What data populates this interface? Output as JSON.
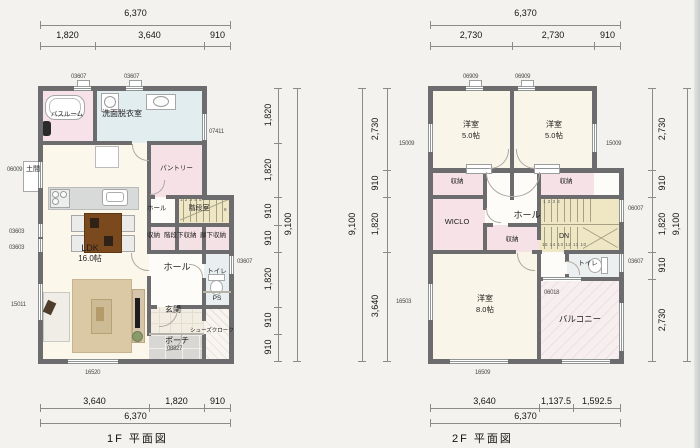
{
  "f1": {
    "caption": "1F 平面図",
    "rooms": {
      "bath": "バスルーム",
      "wash": "洗面脱衣室",
      "doma": "土間",
      "pantry": "パントリー",
      "hall_upper": "ホール",
      "stair": "階段室",
      "sto1": "収納",
      "sto2": "階段下収納",
      "sto3": "廊下収納",
      "ldk_name": "LDK",
      "ldk_size": "16.0帖",
      "hall": "ホール",
      "toilet": "トイレ",
      "ps": "PS",
      "genkan": "玄関",
      "shoes": "シューズクローク",
      "porch": "ポーチ"
    },
    "codes": {
      "top1": "03607",
      "top2": "03607",
      "right_upper": "07411",
      "right_lower": "03607",
      "left_doma": "06009",
      "left1": "03603",
      "left2": "03603",
      "left3": "15011",
      "bottom": "16520",
      "porch": "08827"
    },
    "stair_numbers": {
      "run": "1 2 3 4 5",
      "last": "8"
    },
    "dims": {
      "top_overall": "6,370",
      "top": [
        "1,820",
        "3,640",
        "910"
      ],
      "bottom": [
        "3,640",
        "1,820",
        "910"
      ],
      "bottom_overall": "6,370",
      "right": [
        "1,820",
        "1,820",
        "910",
        "910",
        "1,820",
        "910",
        "910"
      ],
      "right_overall": "9,100"
    }
  },
  "f2": {
    "caption": "2F 平面図",
    "rooms": {
      "bed1_name": "洋室",
      "bed1_size": "5.0帖",
      "bed2_name": "洋室",
      "bed2_size": "5.0帖",
      "stoL": "収納",
      "stoR": "収納",
      "wiclo": "WICLO",
      "hall": "ホール",
      "stoC": "収納",
      "dn": "DN",
      "toilet": "トイレ",
      "bed8_name": "洋室",
      "bed8_size": "8.0帖",
      "balcony": "バルコニー"
    },
    "codes": {
      "top1": "06909",
      "top2": "06909",
      "left_win": "15009",
      "right_win": "15009",
      "right_stair": "06007",
      "right_toilet": "03607",
      "balcony_door": "06018",
      "bottom": "16509",
      "left_low": "16503"
    },
    "stair_numbers": {
      "top": "1 2 3 4",
      "bottom": "15 14 13 12 11 10"
    },
    "dims": {
      "top_overall": "6,370",
      "top": [
        "2,730",
        "2,730",
        "910"
      ],
      "bottom": [
        "3,640",
        "1,137.5",
        "1,592.5"
      ],
      "bottom_overall": "6,370",
      "left": [
        "2,730",
        "910",
        "1,820",
        "3,640"
      ],
      "left_overall": "9,100",
      "right": [
        "2,730",
        "910",
        "1,820",
        "910",
        "2,730"
      ],
      "right_overall": "9,100"
    }
  }
}
